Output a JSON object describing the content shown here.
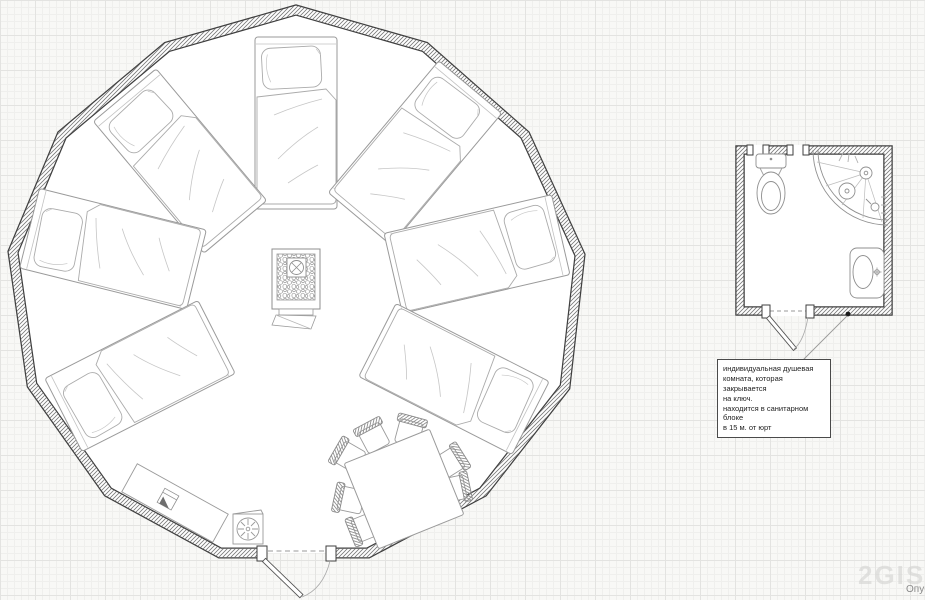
{
  "canvas": {
    "width": 925,
    "height": 600
  },
  "colors": {
    "paper": "#f8f8f6",
    "grid_minor": "#efefed",
    "grid_major": "#e3e3e1",
    "wall_line": "#3f3f3f",
    "wall_hatch": "#787878",
    "furniture_line": "#9a9a9a",
    "furniture_light": "#c2c2c2",
    "fixture_line": "#8f8f8f",
    "leader_line": "#9a9a9a",
    "note_text": "#1f1f1f",
    "watermark_color": "#d2d2d0",
    "caption_color": "#8a8a8a"
  },
  "icons": {
    "stove_chimney": "circle-with-x",
    "fan": "radial-spokes-circle",
    "counter_stove": "square-with-flag",
    "faucet": "circle-cross",
    "shower_head": "circle-dot-spray",
    "shower_drain": "circle-dot",
    "door_lock": "black-dot"
  },
  "yurt": {
    "label": "yurt floor plan",
    "vertices": [
      [
        296,
        10
      ],
      [
        425,
        47
      ],
      [
        525,
        135
      ],
      [
        580,
        255
      ],
      [
        565,
        387
      ],
      [
        483,
        492
      ],
      [
        368,
        553
      ],
      [
        220,
        553
      ],
      [
        108,
        492
      ],
      [
        32,
        385
      ],
      [
        13,
        252
      ],
      [
        62,
        135
      ],
      [
        167,
        47
      ]
    ],
    "door": {
      "gap_start": 262,
      "gap_end": 331,
      "y": 553
    },
    "beds": [
      {
        "cx": 296,
        "cy": 123,
        "rot": 0
      },
      {
        "cx": 415,
        "cy": 153,
        "rot": 40
      },
      {
        "cx": 477,
        "cy": 254,
        "rot": 77
      },
      {
        "cx": 454,
        "cy": 379,
        "rot": 117
      },
      {
        "cx": 180,
        "cy": 161,
        "rot": -40
      },
      {
        "cx": 113,
        "cy": 249,
        "rot": -76
      },
      {
        "cx": 140,
        "cy": 376,
        "rot": -117
      }
    ],
    "stove": {
      "transform": "translate(296 289)"
    },
    "table": {
      "transform": "translate(404 489) rotate(-22)",
      "size": 92
    },
    "chairs": [
      {
        "cx": 350,
        "cy": 457,
        "rot": -60
      },
      {
        "cx": 374,
        "cy": 438,
        "rot": -28
      },
      {
        "cx": 409,
        "cy": 433,
        "rot": 15
      },
      {
        "cx": 449,
        "cy": 463,
        "rot": 58
      },
      {
        "cx": 453,
        "cy": 489,
        "rot": 78
      },
      {
        "cx": 351,
        "cy": 500,
        "rot": -78
      },
      {
        "cx": 366,
        "cy": 527,
        "rot": -112
      }
    ],
    "counter": {
      "transform": "translate(175 503) rotate(29)"
    },
    "appliance": {
      "transform": "translate(248 529)"
    }
  },
  "bathroom": {
    "label": "individual shower room plan",
    "left": 740,
    "top": 150,
    "right": 888,
    "bottom": 311,
    "top_gaps": [
      [
        752,
        764
      ],
      [
        792,
        804
      ]
    ],
    "door_gap": [
      768,
      810
    ]
  },
  "annotation": {
    "lines": [
      "индивидуальная душевая",
      "комната, которая закрывается",
      "на ключ.",
      "находится в санитарном блоке",
      "в 15 м. от юрт"
    ]
  },
  "watermark": {
    "logo": "2GIS",
    "caption": "Опуб"
  }
}
